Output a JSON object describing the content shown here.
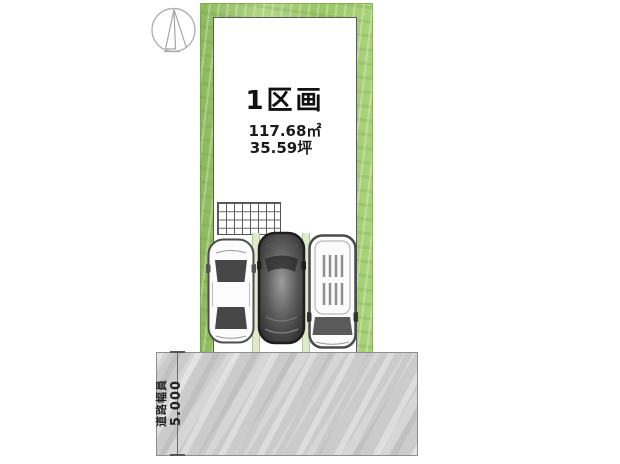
{
  "lot": {
    "label": "1区画",
    "area_m2": "117.68㎡",
    "area_tsubo": "35.59坪"
  },
  "road": {
    "label": "道路幅員",
    "width": "5.000"
  },
  "icons": {
    "compass": "north-compass",
    "cars": [
      "white-sedan",
      "dark-car",
      "white-van"
    ]
  },
  "colors": {
    "hedge_green": "#a5ce74",
    "road_gray": "#cbcbcb",
    "car_dark_body": "#3f3f3f",
    "line_dark": "#5a5a5a"
  }
}
